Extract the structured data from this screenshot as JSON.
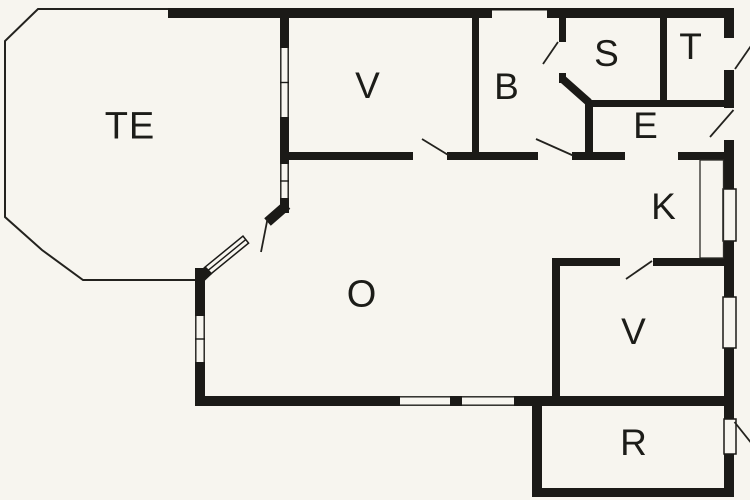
{
  "colors": {
    "background": "#f7f5ef",
    "wall": "#1b1a17",
    "line": "#23221e"
  },
  "rooms": [
    {
      "id": "te",
      "label": "TE"
    },
    {
      "id": "v-top",
      "label": "V"
    },
    {
      "id": "b",
      "label": "B"
    },
    {
      "id": "s",
      "label": "S"
    },
    {
      "id": "t",
      "label": "T"
    },
    {
      "id": "e",
      "label": "E"
    },
    {
      "id": "k",
      "label": "K"
    },
    {
      "id": "o",
      "label": "O"
    },
    {
      "id": "v-bottom",
      "label": "V"
    },
    {
      "id": "r",
      "label": "R"
    }
  ]
}
